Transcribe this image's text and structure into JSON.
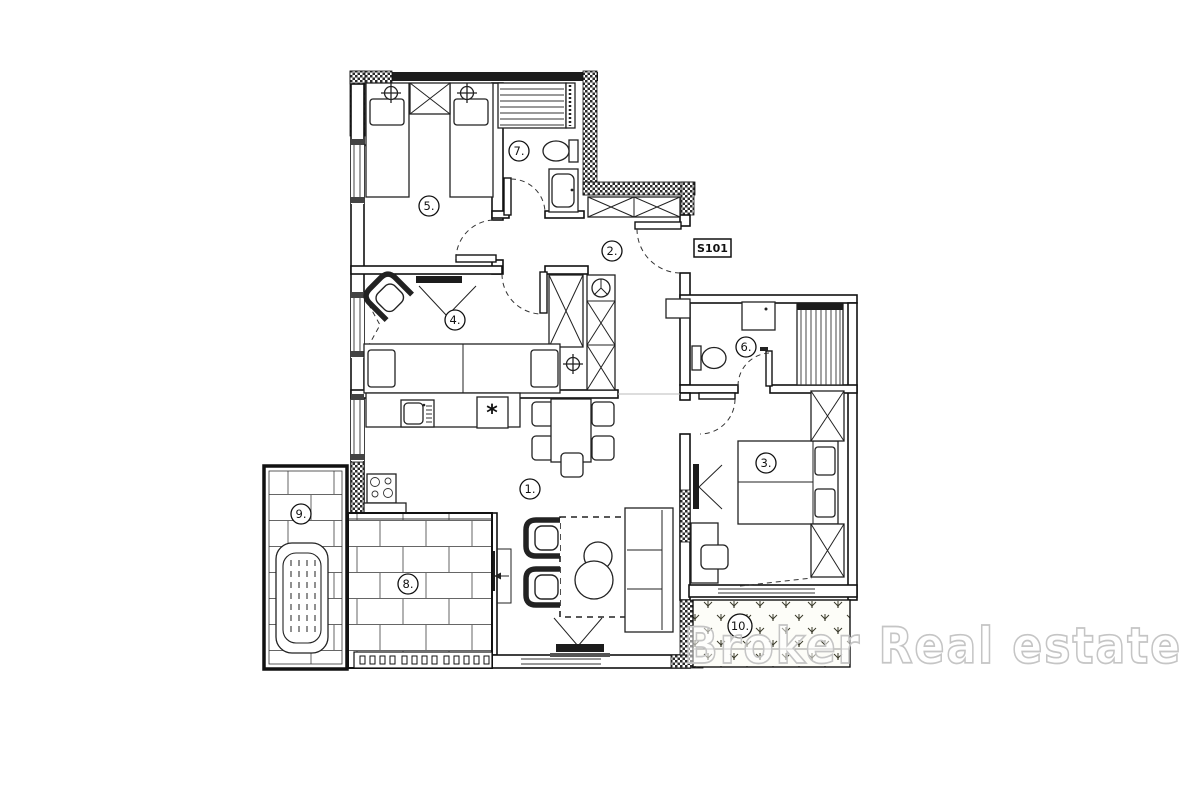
{
  "floor_plan": {
    "unit_label": "S101",
    "watermark_text": "Broker Real estate",
    "room_labels": [
      "1.",
      "2.",
      "3.",
      "4.",
      "5.",
      "6.",
      "7.",
      "8.",
      "9.",
      "10."
    ],
    "kitchen_appliance_mark": "*",
    "colors": {
      "wall": "#111111",
      "paper": "#ffffff",
      "watermark_outline": "#c5c5c5",
      "brick_line": "#666666",
      "garden_mark": "#3a3a2a"
    }
  }
}
